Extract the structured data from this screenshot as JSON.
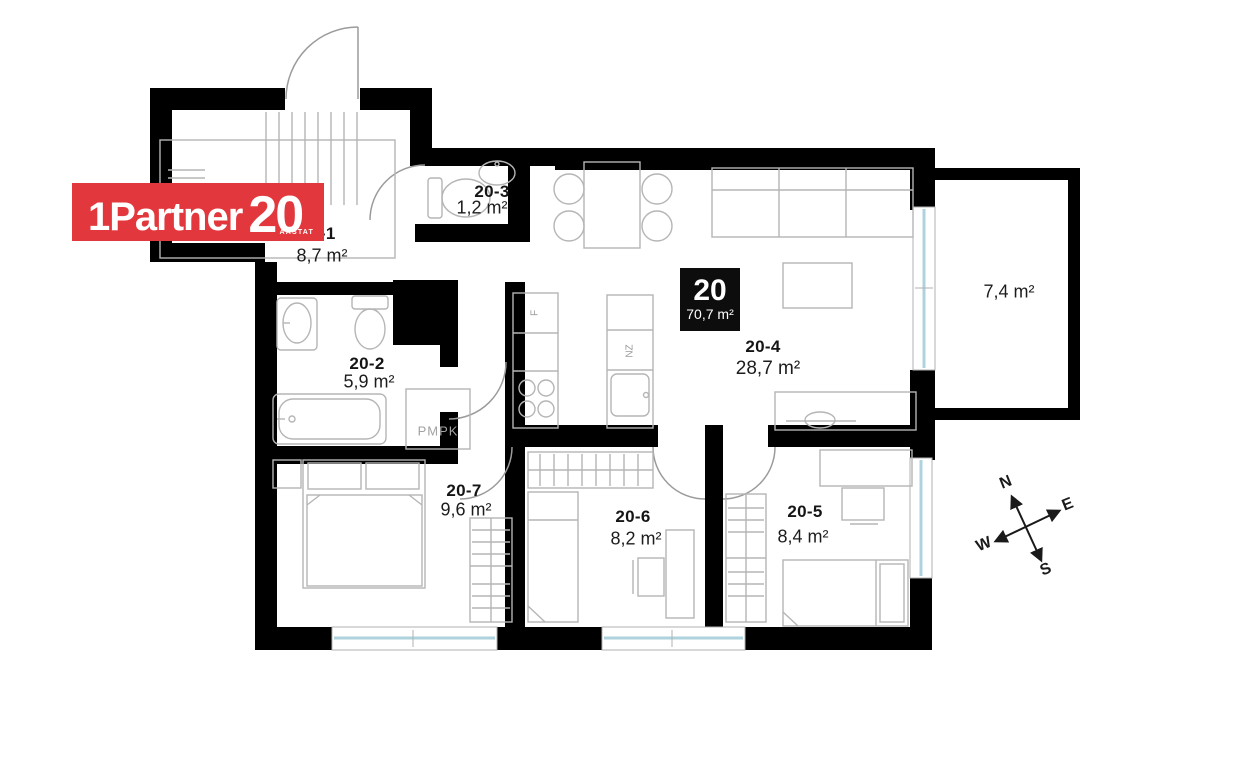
{
  "logo": {
    "brand": "1Partner",
    "anniversary": "20",
    "sub": "AASTAT",
    "bg_color": "#e2383d"
  },
  "unit_badge": {
    "number": "20",
    "total_area": "70,7 m²"
  },
  "rooms": [
    {
      "id": "20-1",
      "area": "8,7 m²"
    },
    {
      "id": "20-2",
      "area": "5,9 m²"
    },
    {
      "id": "20-3",
      "area": "1,2 m²"
    },
    {
      "id": "20-4",
      "area": "28,7 m²"
    },
    {
      "id": "20-5",
      "area": "8,4 m²"
    },
    {
      "id": "20-6",
      "area": "8,2 m²"
    },
    {
      "id": "20-7",
      "area": "9,6 m²"
    }
  ],
  "balcony": {
    "area": "7,4 m²"
  },
  "annotations": {
    "pmpk": "PMPK",
    "fridge": "F",
    "dishwasher": "NZ"
  },
  "compass": {
    "n": "N",
    "e": "E",
    "s": "S",
    "w": "W"
  },
  "colors": {
    "wall": "#000000",
    "glazing": "#aed3dc",
    "furniture": "#b5b5b5",
    "logo_red": "#e2383d"
  }
}
